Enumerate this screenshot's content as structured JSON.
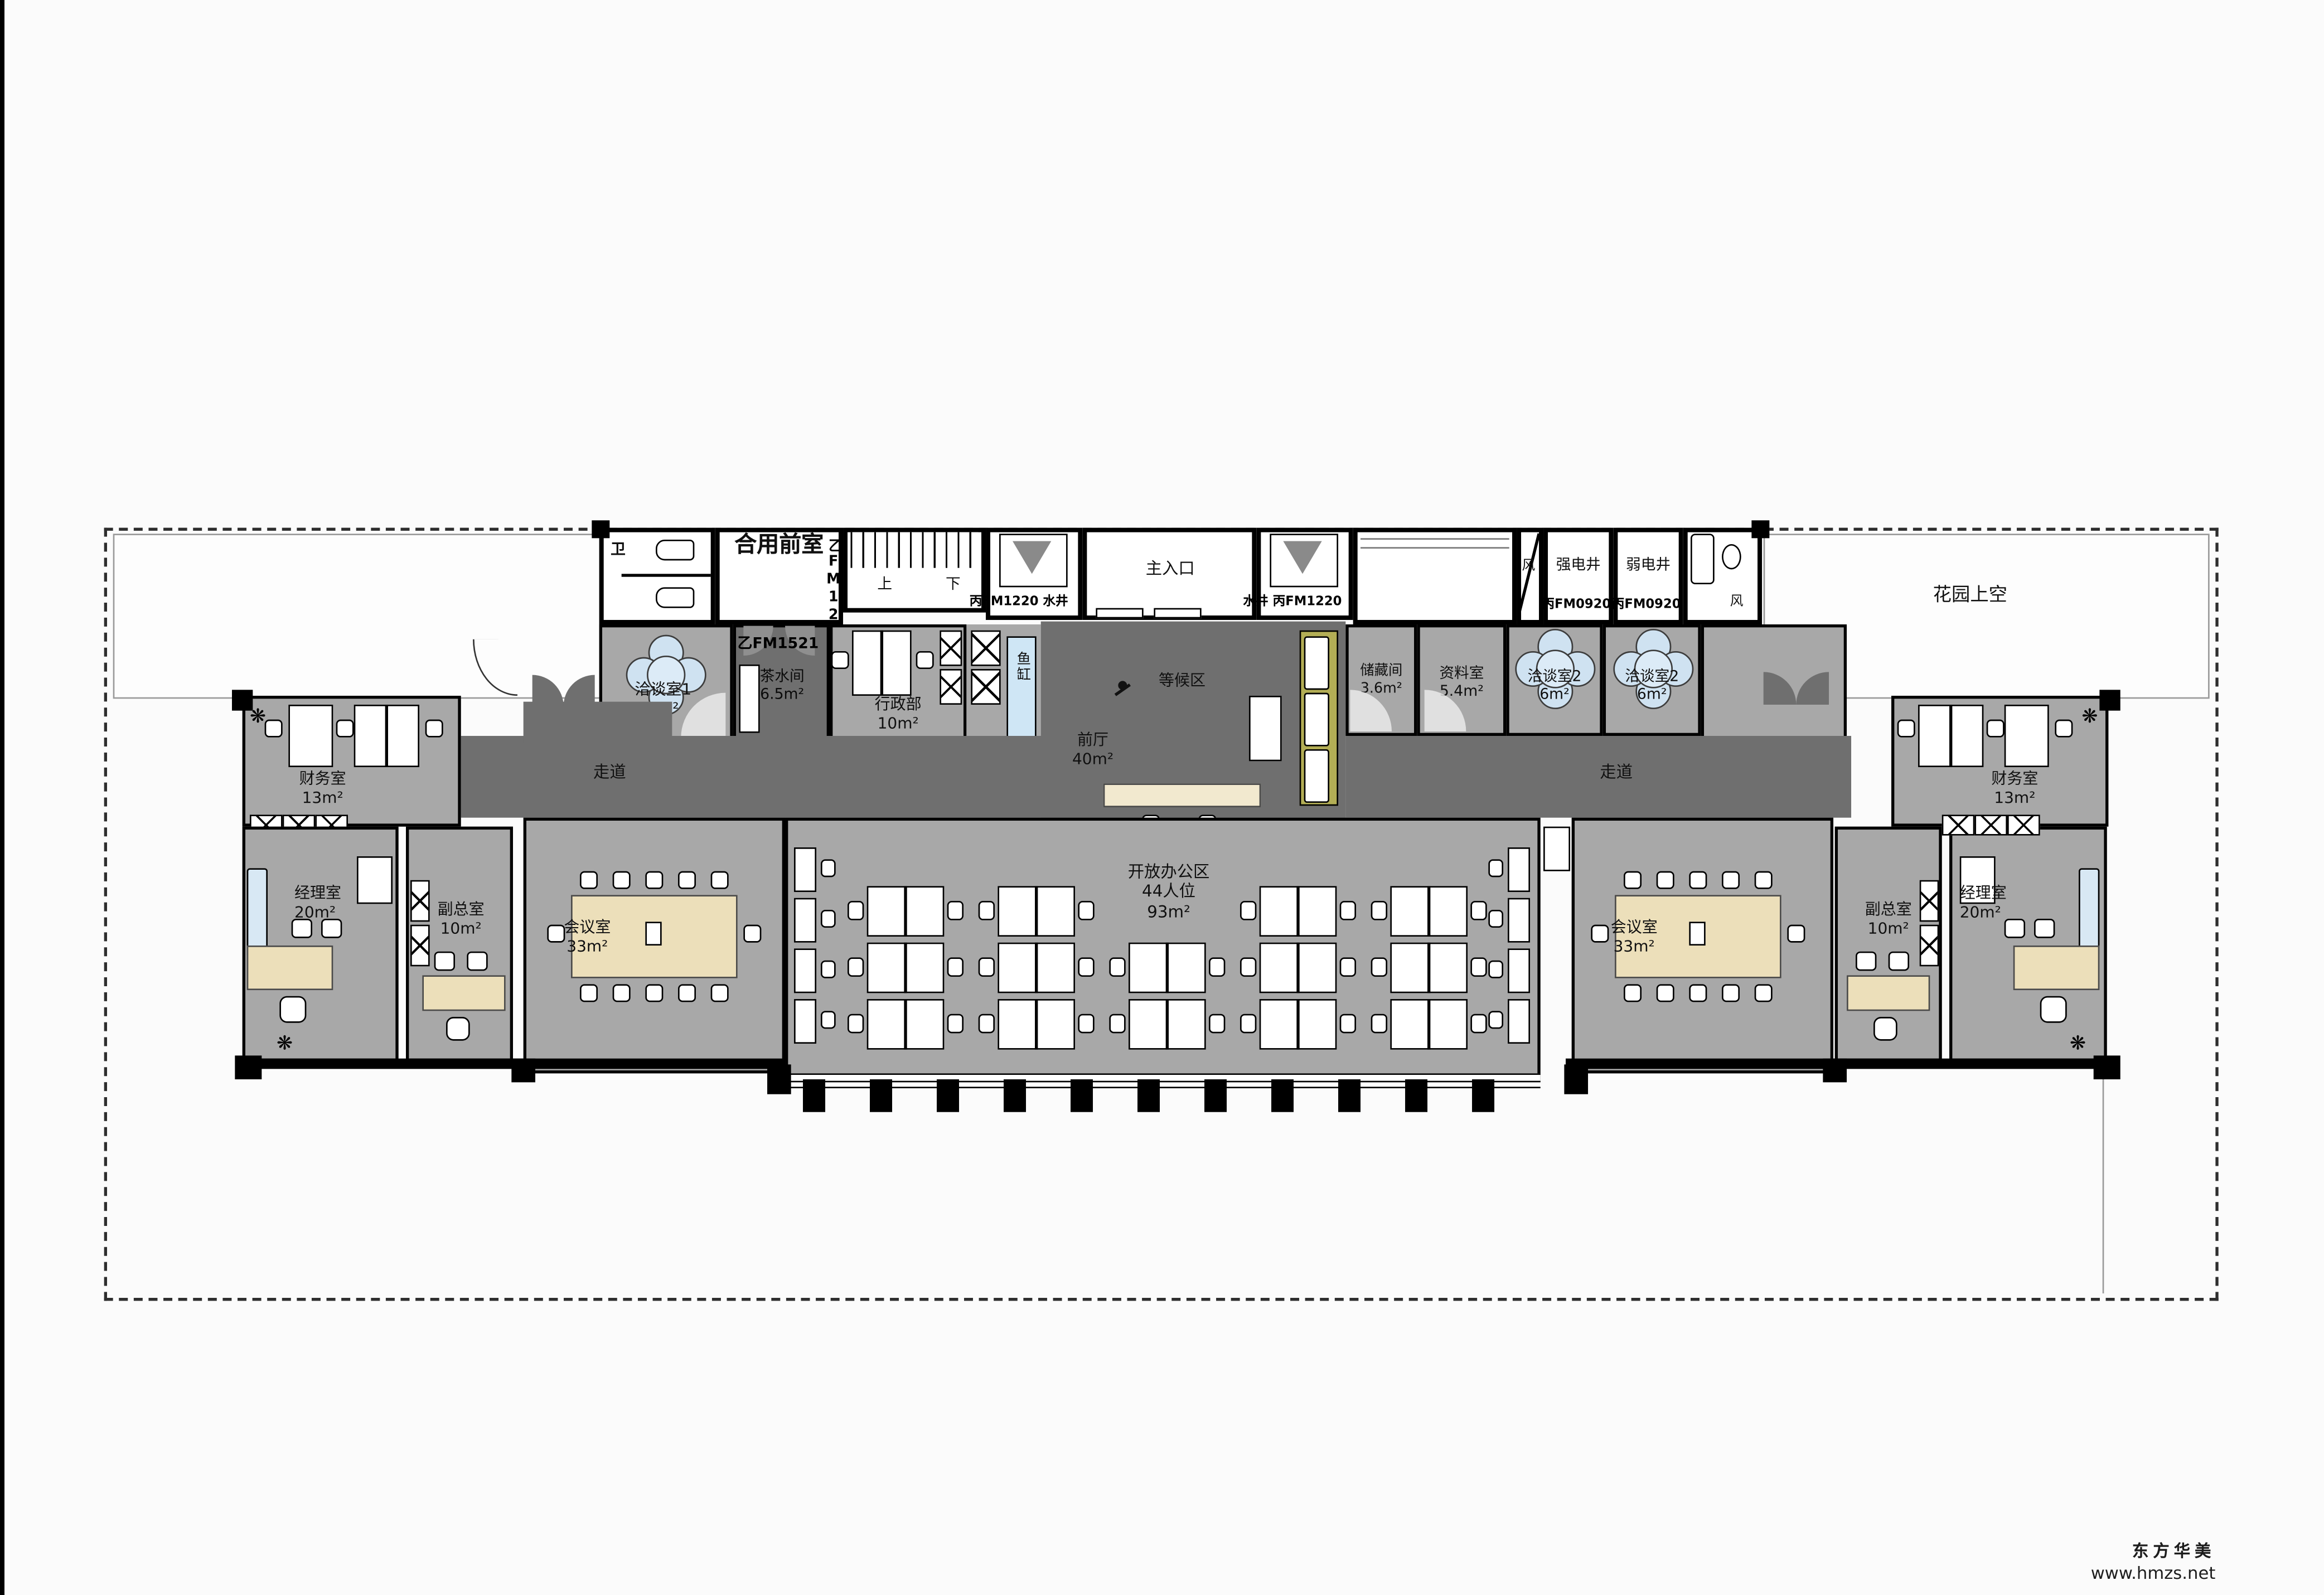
{
  "site": {
    "garden": "花园上空",
    "corridor": "走道",
    "terrace_note": "",
    "boundary": "dashed-property-line"
  },
  "core": {
    "shared_vestibule": "合用前室",
    "toilet": "卫",
    "stair_up": "上",
    "stair_down": "下",
    "main_entrance": "主入口",
    "strong_shaft": "强电井",
    "weak_shaft": "弱电井",
    "vent": "风"
  },
  "tags": {
    "fd1221": "乙FM1221",
    "fd1521": "乙FM1521",
    "fd1220_left": "丙FM1220 水井",
    "fd1220_right": "水井 丙FM1220",
    "fd0920": "丙FM0920"
  },
  "rooms": {
    "negotiation1": {
      "name": "洽谈室1",
      "area": "7m²"
    },
    "pantry": {
      "name": "茶水间",
      "area": "6.5m²"
    },
    "admin": {
      "name": "行政部",
      "area": "10m²"
    },
    "fish_tank": {
      "name": "鱼缸"
    },
    "lobby": {
      "name": "前厅",
      "area": "40m²"
    },
    "waiting": {
      "name": "等候区"
    },
    "storage": {
      "name": "储藏间",
      "area": "3.6m²"
    },
    "archive": {
      "name": "资料室",
      "area": "5.4m²"
    },
    "negotiation2a": {
      "name": "洽谈室2",
      "area": "6m²"
    },
    "negotiation2b": {
      "name": "洽谈室2",
      "area": "6m²"
    },
    "finance_left": {
      "name": "财务室",
      "area": "13m²"
    },
    "finance_right": {
      "name": "财务室",
      "area": "13m²"
    },
    "manager_left": {
      "name": "经理室",
      "area": "20m²"
    },
    "manager_right": {
      "name": "经理室",
      "area": "20m²"
    },
    "deputy_left": {
      "name": "副总室",
      "area": "10m²"
    },
    "deputy_right": {
      "name": "副总室",
      "area": "10m²"
    },
    "meeting_left": {
      "name": "会议室",
      "area": "33m²"
    },
    "meeting_right": {
      "name": "会议室",
      "area": "33m²"
    },
    "open_office": {
      "name": "开放办公区",
      "seats": "44人位",
      "area": "93m²"
    }
  },
  "watermark": {
    "brand": "东方华美",
    "url": "www.hmzs.net"
  },
  "colors": {
    "room_gray": "#a8a8a8",
    "corridor_gray": "#6f6f6f",
    "wall_black": "#000000",
    "table_beige": "#ecdfba",
    "sofa_olive": "#b3ae55",
    "seat_blue": "#cfe2f1",
    "background": "#fbfbfb"
  }
}
